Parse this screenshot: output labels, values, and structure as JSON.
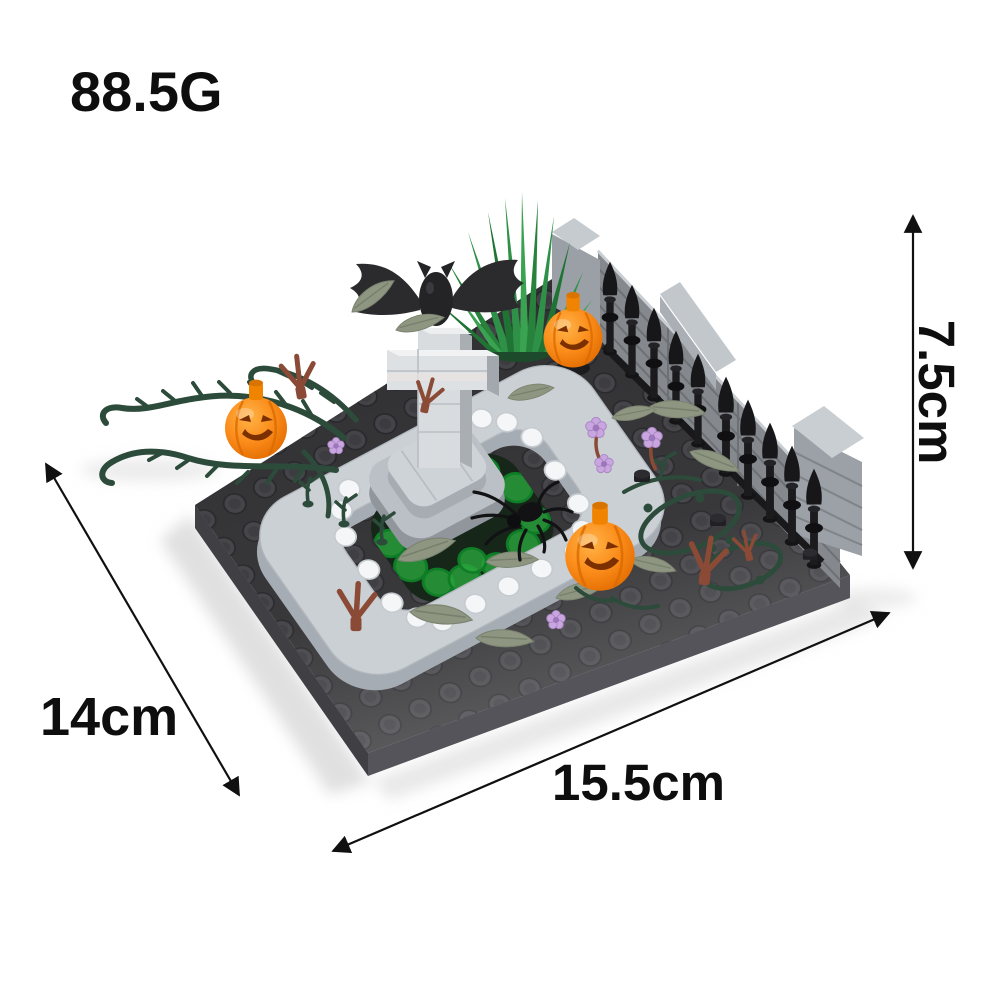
{
  "annotations": {
    "weight": "88.5G",
    "height": "7.5cm",
    "width": "14cm",
    "length": "15.5cm"
  },
  "scene": {
    "description": "Brick-built Halloween graveyard micro build: dark studded baseplate with gray stone fountain, cross tombstone topped by a black bat, stone wall with black picket fence, three jack-o-lantern pumpkins, thorny vines, sage leaves, purple flowers, brown twigs and a black spider",
    "parts": [
      "baseplate",
      "stone-wall",
      "picket-fence",
      "grass-tuft",
      "fountain",
      "cross-tombstone",
      "bat",
      "pumpkin-top",
      "pumpkin-left",
      "pumpkin-bottom",
      "vines-left",
      "vines-right",
      "leaves",
      "twigs",
      "flowers",
      "spider"
    ],
    "colors": {
      "background": "#ffffff",
      "baseplate": "#2e2e31",
      "baseplate_side": "#4b4b50",
      "fountain_gray": "#cbd0d5",
      "cross_gray": "#d8dcdf",
      "water_green": "#2aa83e",
      "pumpkin_orange": "#fb8c1a",
      "wall_gray": "#85898e",
      "fence_black": "#1b1b1e",
      "vine_green": "#2d4b3b",
      "leaf_sage": "#8e9681",
      "flower_lavender": "#c9a6df",
      "twig_brown": "#8a4a36",
      "annotation_text": "#0e0e0e"
    }
  }
}
